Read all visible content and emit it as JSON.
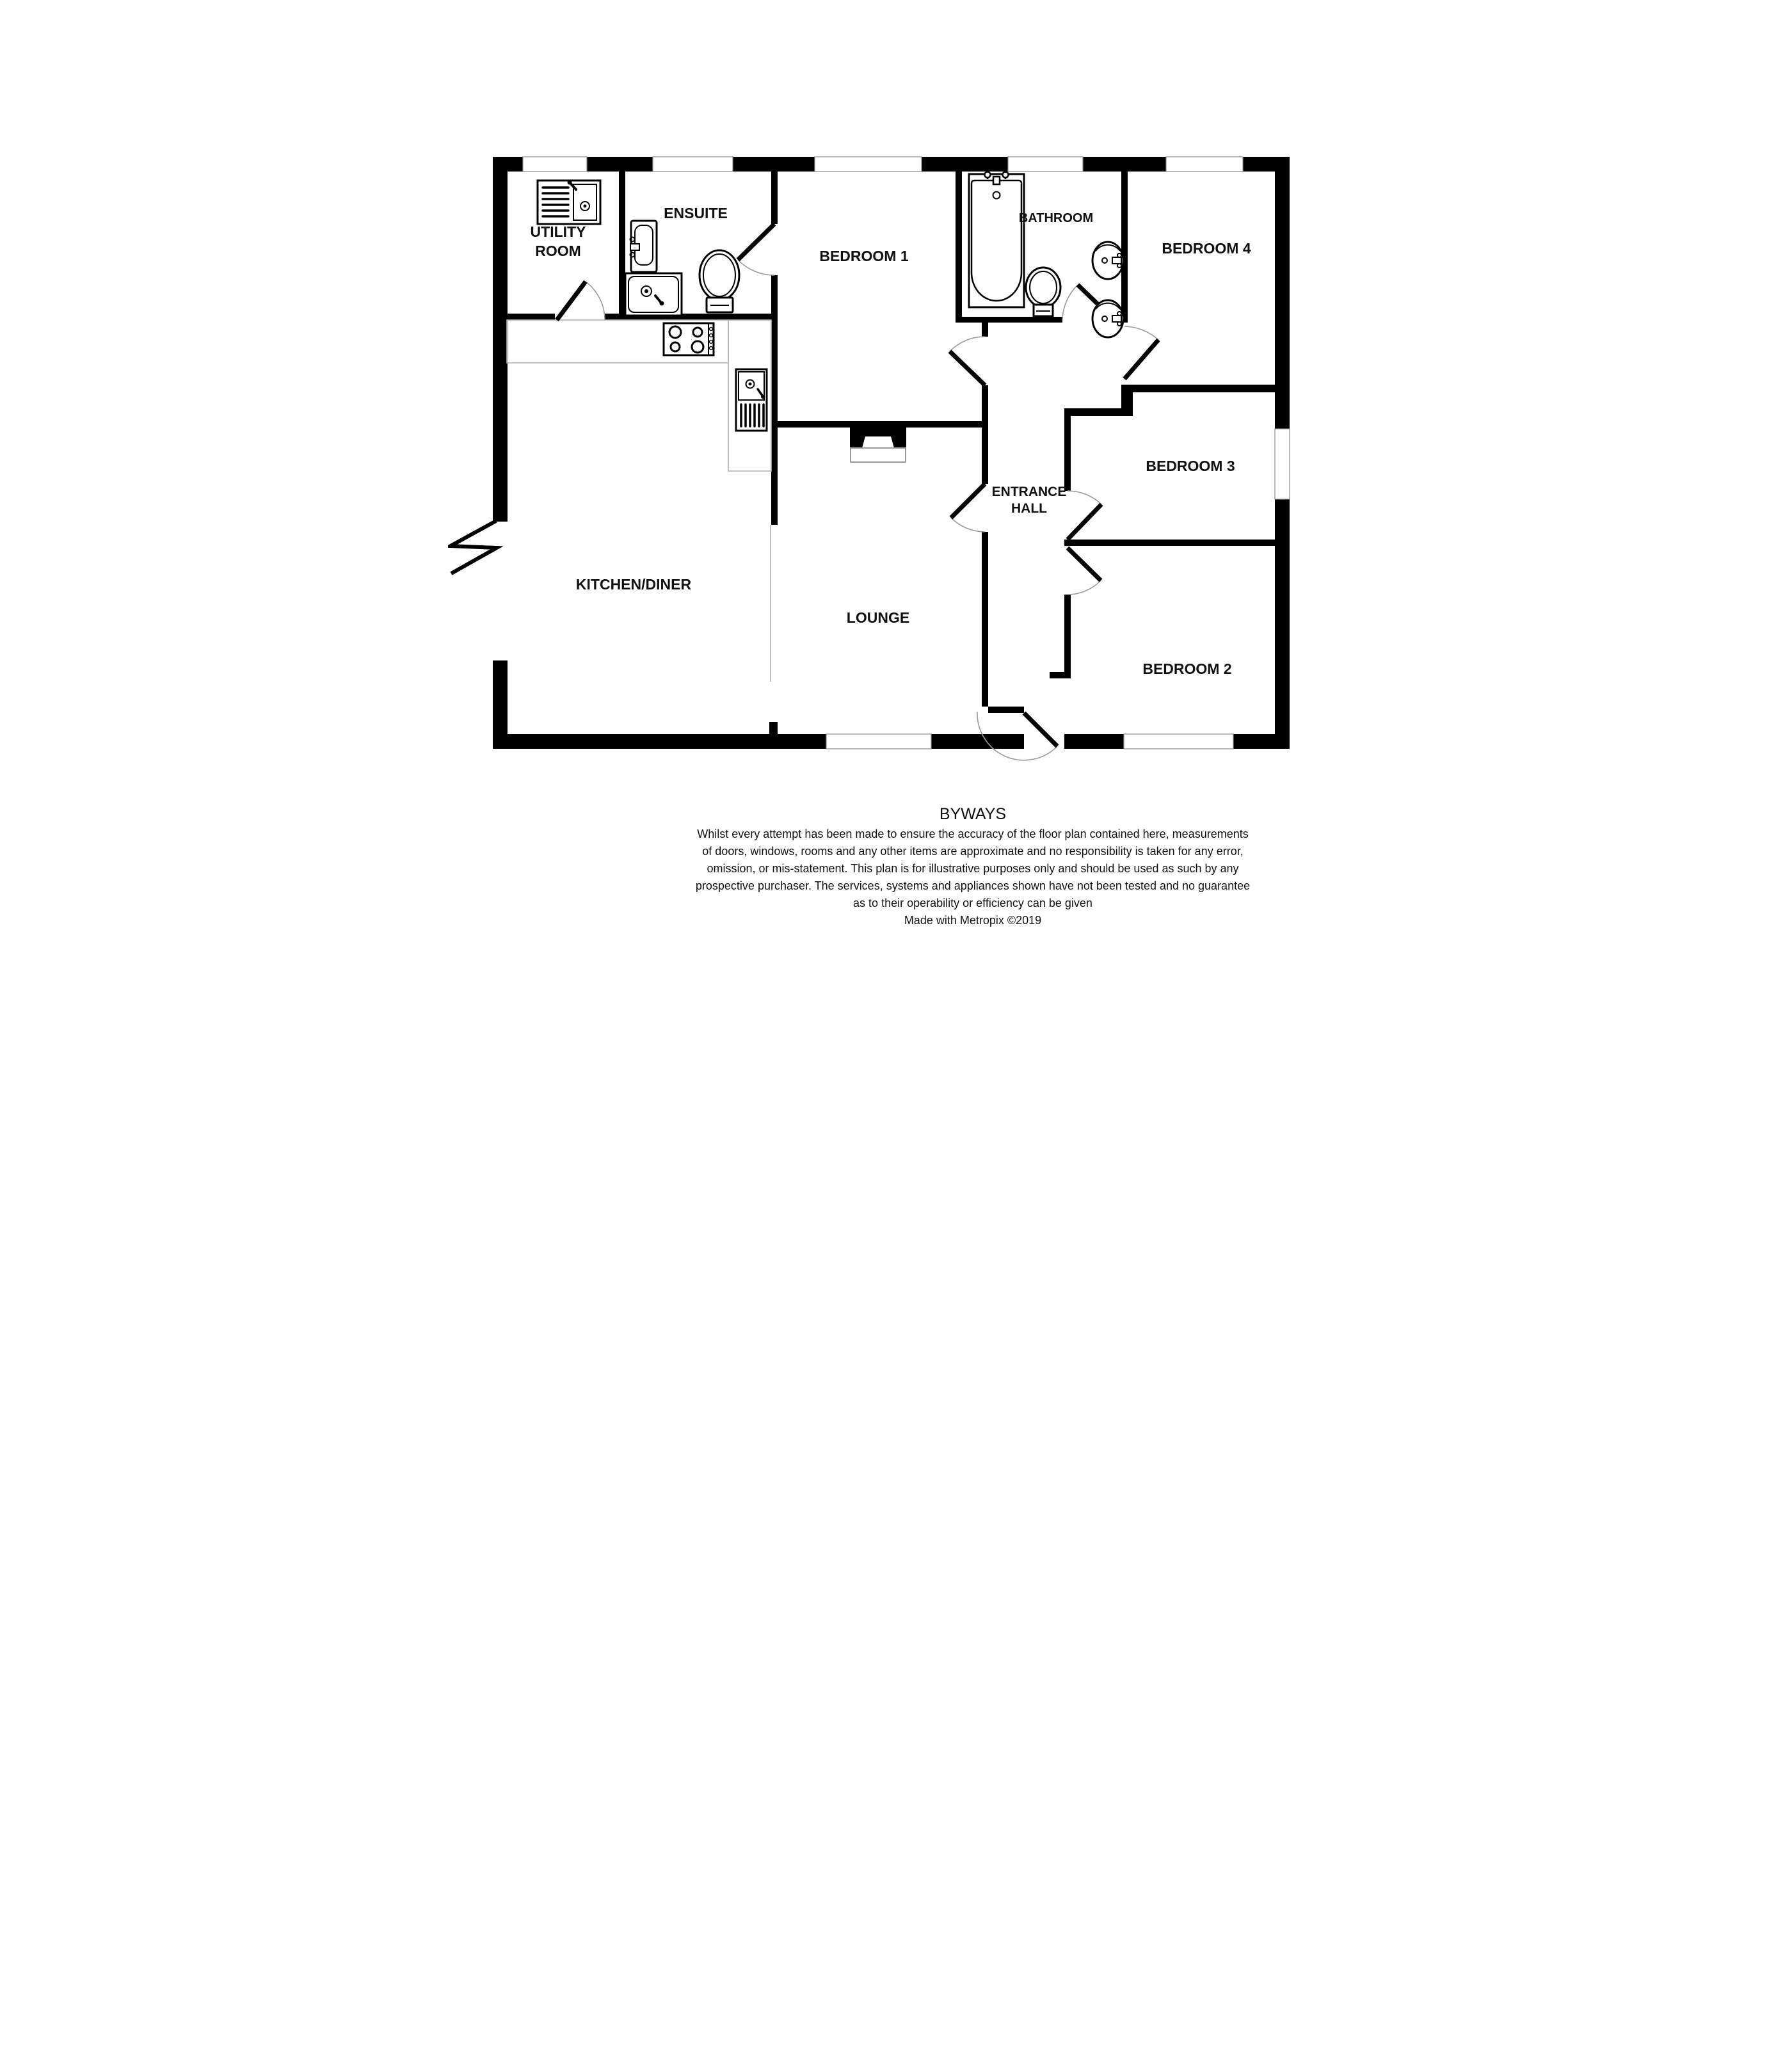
{
  "property_name": "BYWAYS",
  "rooms": {
    "utility_line1": "UTILITY",
    "utility_line2": "ROOM",
    "ensuite": "ENSUITE",
    "bedroom1": "BEDROOM 1",
    "bathroom": "BATHROOM",
    "bedroom4": "BEDROOM 4",
    "kitchen_diner": "KITCHEN/DINER",
    "entrance_line1": "ENTRANCE",
    "entrance_line2": "HALL",
    "bedroom3": "BEDROOM 3",
    "lounge": "LOUNGE",
    "bedroom2": "BEDROOM 2"
  },
  "footer": {
    "disclaimer_lines": [
      "Whilst every attempt has been made to ensure the accuracy of the floor plan contained here, measurements",
      "of doors, windows, rooms and any other items are approximate and no responsibility is taken for any error,",
      "omission, or mis-statement. This plan is for illustrative purposes only and should be used as such by any",
      "prospective purchaser. The services, systems and appliances shown have not been tested and no guarantee",
      "as to their operability or efficiency can be given"
    ],
    "credit": "Made with Metropix ©2019"
  },
  "icons": {
    "fixtures": [
      "utility-sink-icon",
      "ensuite-basin-icon",
      "shower-tray-icon",
      "toilet-icon",
      "hob-icon",
      "kitchen-sink-icon",
      "bathtub-icon",
      "pedestal-basin-icon",
      "chimney-breast-icon",
      "wall-break-icon"
    ]
  },
  "colors": {
    "wall": "#000000",
    "floor": "#ffffff",
    "counter_outline": "#b3b3b3",
    "door_arc": "#9a9a9a"
  }
}
